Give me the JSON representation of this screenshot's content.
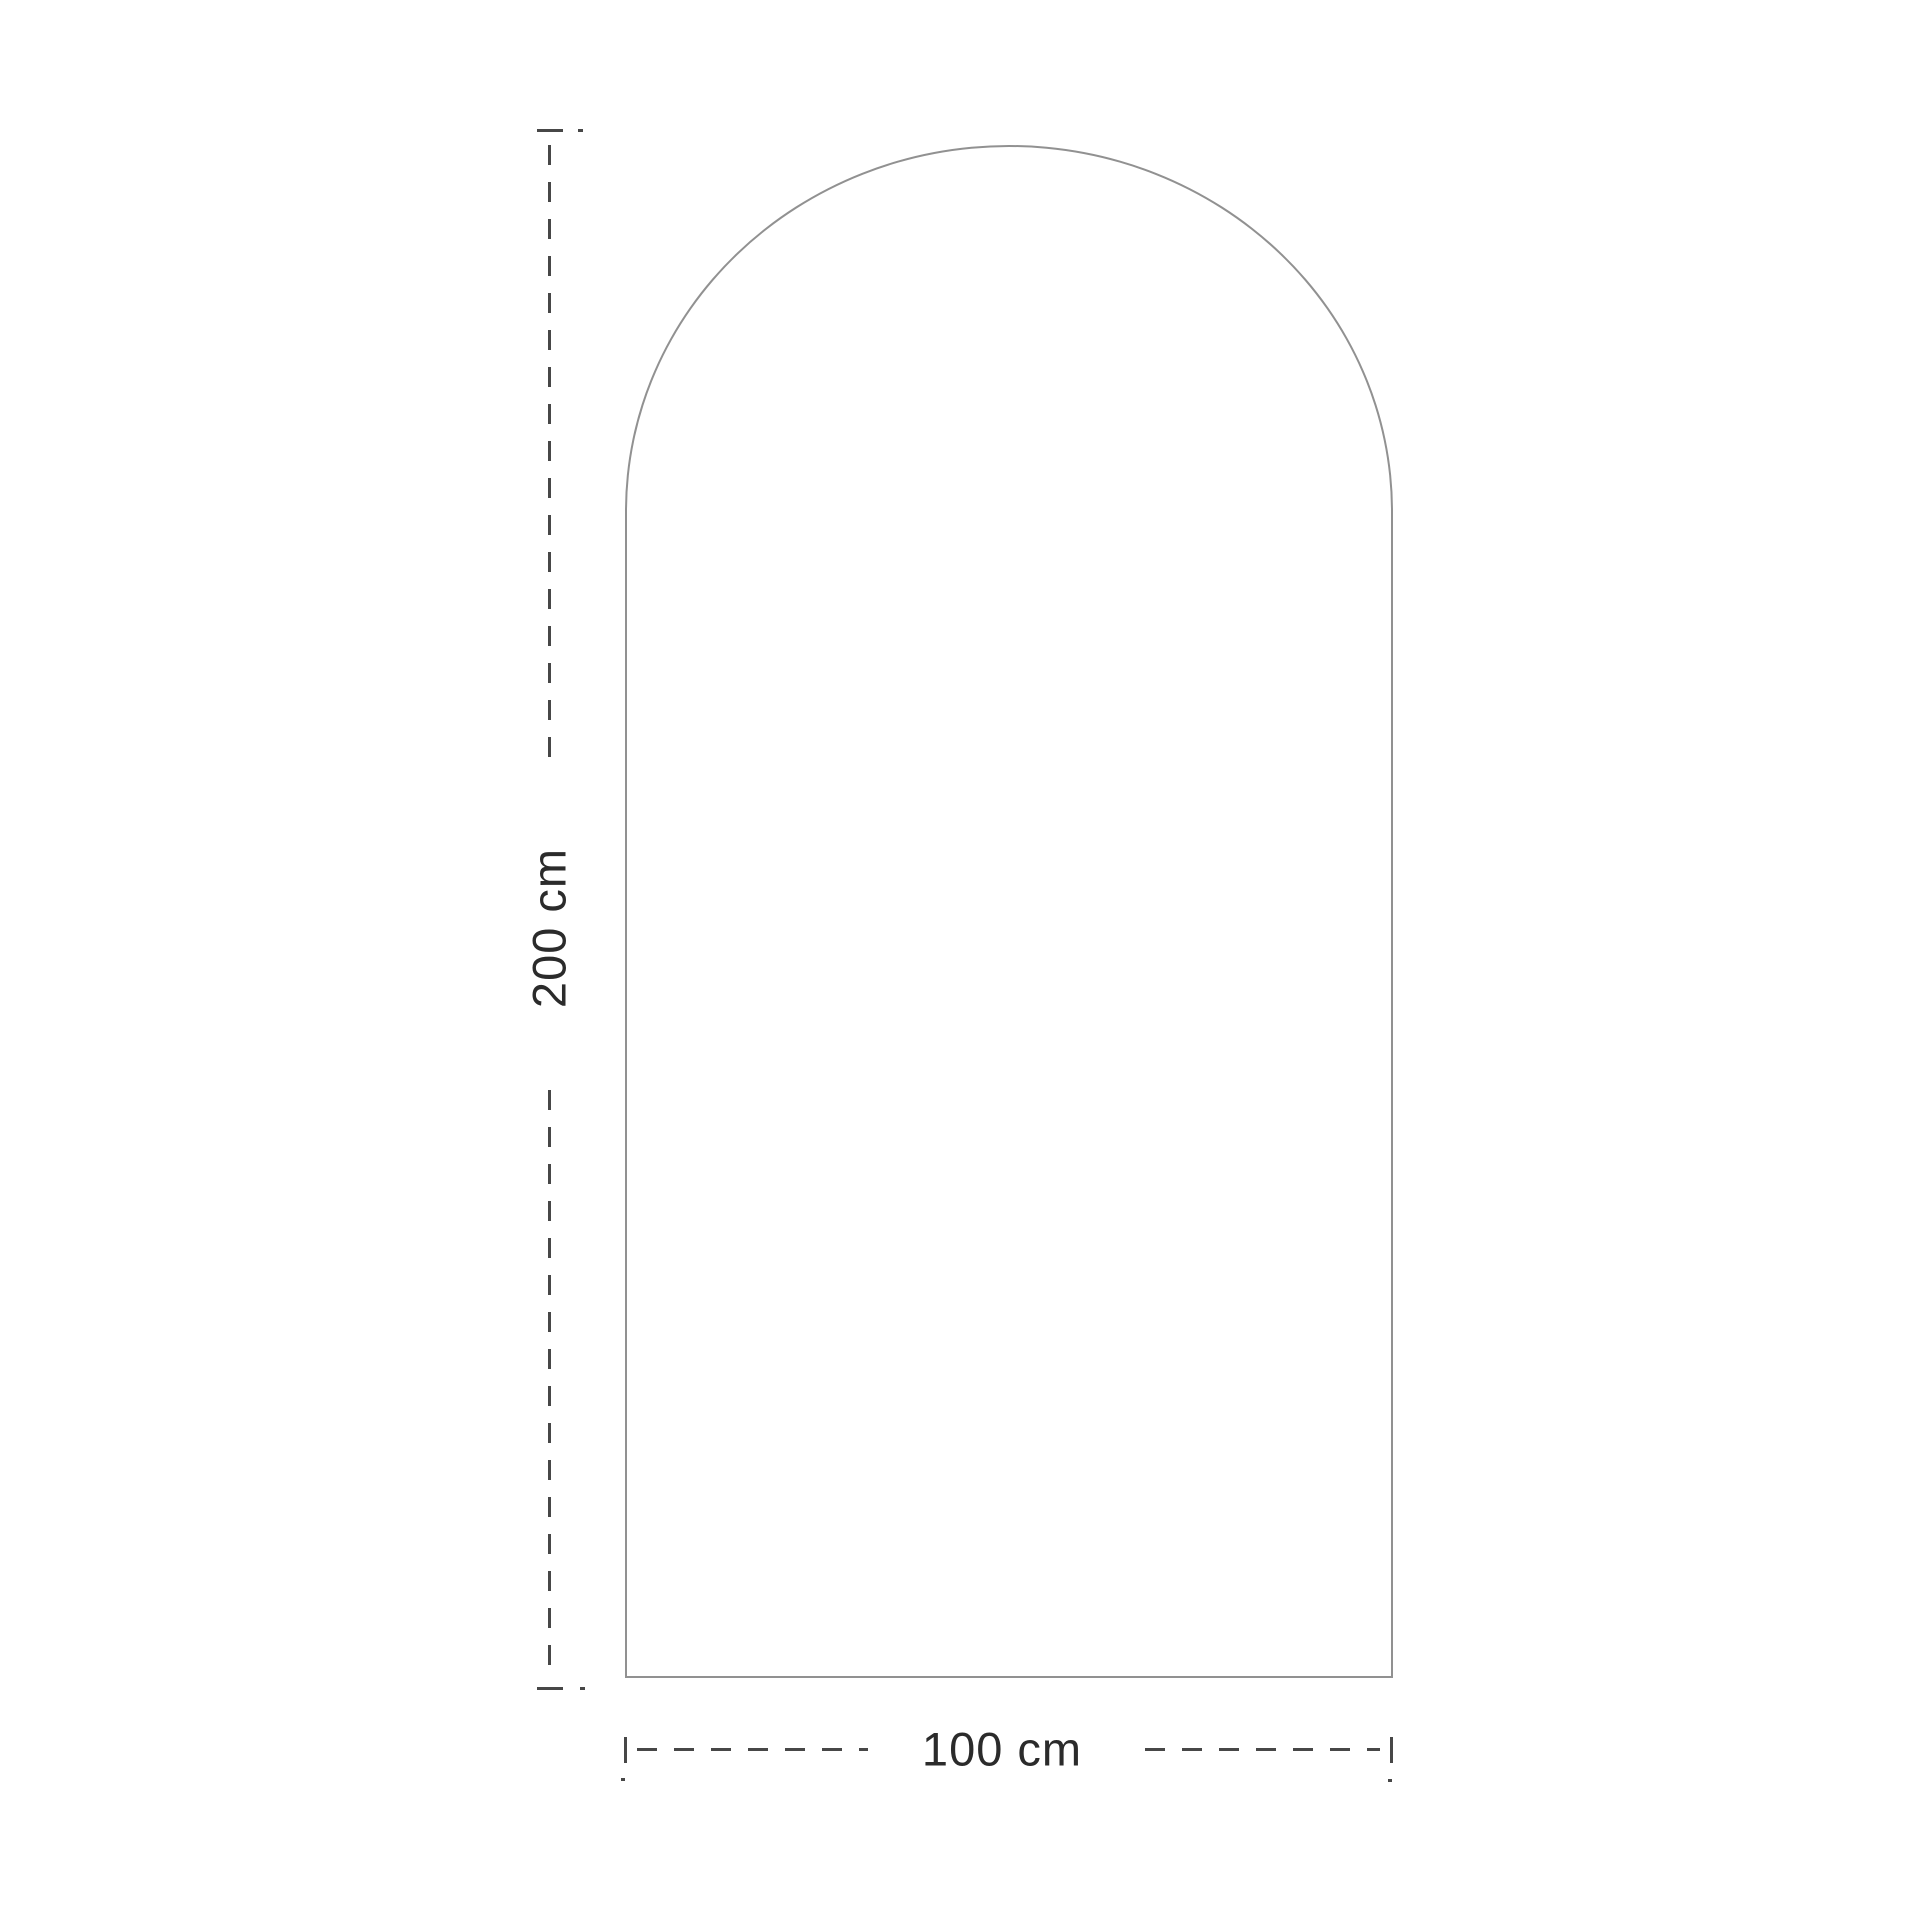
{
  "diagram": {
    "type": "product-dimension-drawing",
    "shape": "arched-panel",
    "labels": {
      "height": "200 cm",
      "width": "100 cm"
    },
    "colors": {
      "background": "#ffffff",
      "shape_outline": "#919191",
      "dimension_line": "#474747",
      "label_text": "#2b2b2b"
    }
  }
}
